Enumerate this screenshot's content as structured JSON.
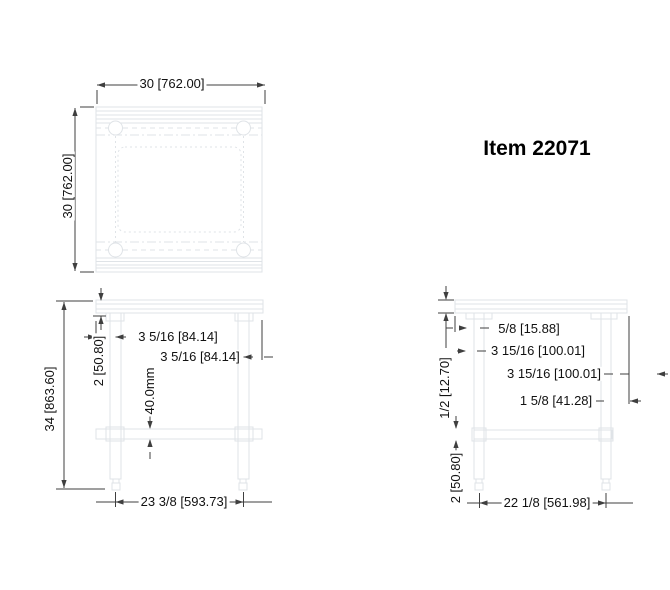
{
  "item_label": "Item 22071",
  "top_view": {
    "width_dim": "30 [762.00]",
    "depth_dim": "30 [762.00]"
  },
  "front_view": {
    "overall_height_dim": "34 [863.60]",
    "top_assembly_dim": "2 [50.80]",
    "left_leg_offset_dim": "3 5/16 [84.14]",
    "right_leg_offset_dim": "3 5/16 [84.14]",
    "shelf_channel_dim": "40.0mm",
    "leg_span_dim": "23 3/8 [593.73]"
  },
  "side_view": {
    "top_thickness_dim": "1/2 [12.70]",
    "edge_offset_dim": "5/8 [15.88]",
    "left_leg_offset_dim": "3 15/16 [100.01]",
    "right_leg_offset_dim": "3 15/16 [100.01]",
    "leg_width_dim": "1 5/8 [41.28]",
    "shelf_offset_dim": "2 [50.80]",
    "leg_span_dim": "22 1/8 [561.98]"
  },
  "colors": {
    "background": "#ffffff",
    "drawing_line": "#dfe3e7",
    "dimension_line": "#3f3f3f",
    "text": "#111111"
  }
}
